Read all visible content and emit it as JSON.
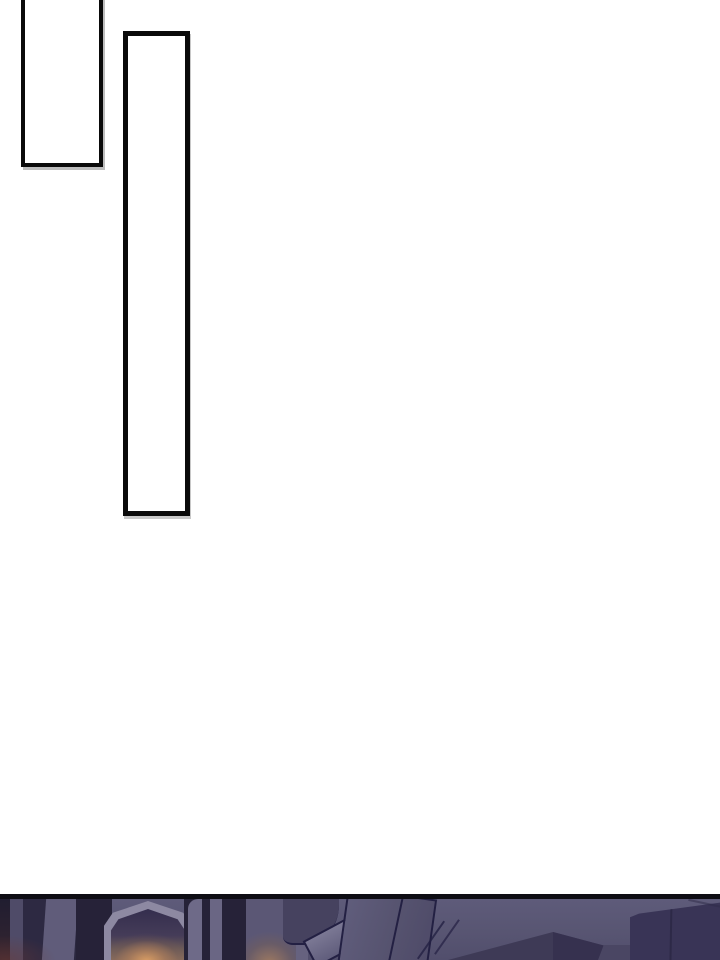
{
  "page": {
    "kind": "webtoon-comic-page",
    "background": "#ffffff"
  },
  "speech_bubbles": [
    {
      "name": "bubble-1",
      "text": "",
      "shape": "vertical-rectangle",
      "position": "top-left, cropped by top edge"
    },
    {
      "name": "bubble-2",
      "text": "",
      "shape": "tall-vertical-rectangle",
      "position": "right of bubble-1"
    }
  ],
  "bottom_panel": {
    "scene": "dark night interior: arched doorway with warm lamp glow, window pillars at left, tilted fallen boards at center, dark cabinet at right",
    "separator": "black horizontal rule at panel top"
  },
  "colors": {
    "page-bg": "#ffffff",
    "bubble-border": "#0a0a0a",
    "bubble-fill": "#ffffff",
    "panel-border": "#0e0d14",
    "wall-top": "#5e5b7a",
    "wall-bottom": "#514e6c",
    "dark-structure": "#2b2840",
    "band-darkest": "#201d30",
    "band-dark": "#2d2942",
    "band-mid": "#4f4b68",
    "band-light": "#605c7a",
    "mid-dark": "#262238",
    "pillar-light": "#6e6a88",
    "pillar-light2": "#6a6684",
    "arch-outline": "#8d89a2",
    "arch-inner": "#342e4e",
    "glow-core": "#c08a5c",
    "glow-soft": "#a87e60",
    "glow-panel-bg": "#5b5775",
    "edge-band": "#66627f",
    "blob": "#46425f",
    "outline-dark": "#232043",
    "slab-small-top": "#7b7894",
    "slab-small-bottom": "#605d7c",
    "slab-large-light": "#605d7c",
    "slab-large-dark": "#4e4a68",
    "floor-wedge": "#3e3a56",
    "floor-wedge-dark": "#36314f",
    "wardrobe": "#393456",
    "wardrobe-seam": "#2d2947",
    "side-quad": "#4a4663"
  }
}
